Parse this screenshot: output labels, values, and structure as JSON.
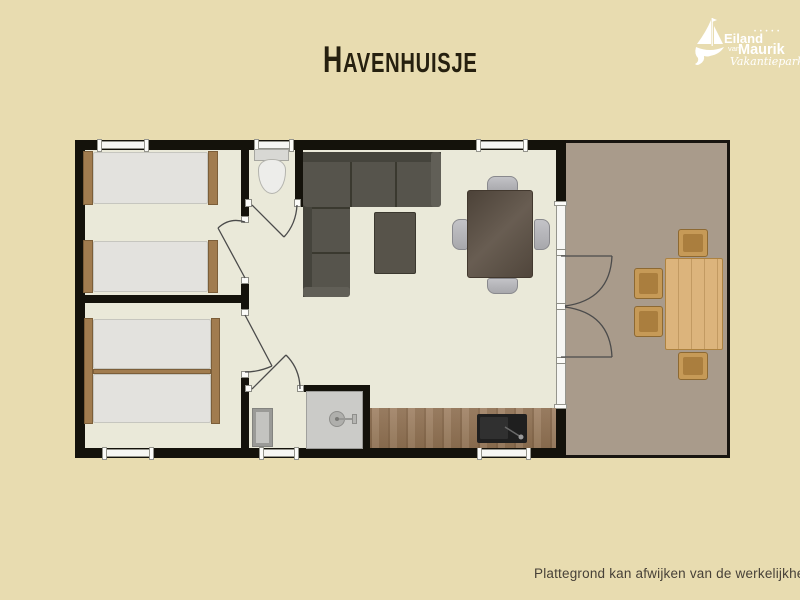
{
  "header": {
    "title": "Havenhuisje"
  },
  "logo": {
    "line1": "Eiland",
    "line2": "van",
    "line3": "Maurik",
    "dots": "• • • • •",
    "subtitle": "Vakantiepark"
  },
  "footer": {
    "disclaimer": "Plattegrond kan afwijken van de werkelijkheid"
  },
  "floorplan": {
    "rooms": [
      "bedroom-1",
      "bedroom-2",
      "toilet",
      "bathroom",
      "hallway",
      "living-room",
      "kitchen",
      "terrace"
    ],
    "furniture": [
      "single-bed",
      "single-bed",
      "double-bed",
      "toilet",
      "washbasin",
      "shower",
      "corner-sofa",
      "coffee-table",
      "dining-table",
      "dining-chair",
      "kitchen-counter",
      "kitchen-sink",
      "terrace-table",
      "terrace-chair"
    ],
    "colors": {
      "background": "#e8dcb0",
      "floor": "#eae9d9",
      "wall": "#14120b",
      "terrace": "#a99b8b",
      "counter_wood": "#9c7f60",
      "bed_wood": "#a17c4f",
      "sofa": "#56544c",
      "terrace_wood": "#dcb47c",
      "title_text": "#26200f",
      "logo": "#ffffff"
    }
  }
}
